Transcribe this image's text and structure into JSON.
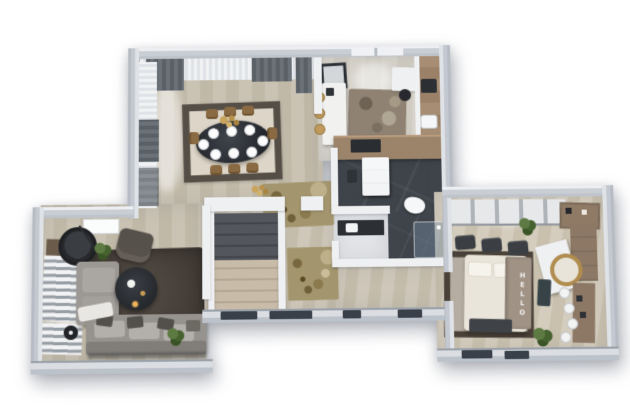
{
  "scene": {
    "title": "3D apartment floor plan render",
    "view": "top-down isometric",
    "background": "#ffffff"
  },
  "palette": {
    "wall": "#c9ced5",
    "wall-top": "#f4f5f7",
    "wall-inner": "#dadde2",
    "wood-light": "#cac3b4",
    "wood-hall": "#cfc8ba",
    "marble-dark": "#3f444b",
    "rug-cream": "#ddd5c7",
    "rug-border": "#554e46",
    "rug-gold": "#a3956d",
    "rug-charcoal": "#46403a",
    "rug-taupe": "#b5ada1",
    "sofa-gray": "#96928d",
    "cabinet-wood": "#a68d73",
    "accent-wood": "#8d7866",
    "table-dark": "#33373d",
    "chair-tan": "#8a6a42",
    "gold": "#b08c4e",
    "plant-green": "#4c6834",
    "shower-glass": "#7a90a8"
  },
  "rooms": [
    {
      "id": "dining-room",
      "features": [
        "oval-dining-table",
        "eight-place-settings",
        "tan-chairs",
        "gold-chandelier",
        "cream-rug",
        "gray-curtains"
      ]
    },
    {
      "id": "kitchen",
      "features": [
        "white-island",
        "bar-stools",
        "wood-cabinets",
        "sink",
        "window",
        "shag-rug",
        "desk-with-chair"
      ]
    },
    {
      "id": "bathroom",
      "features": [
        "dark-marble-floor",
        "white-vanity",
        "toilet",
        "glass-shower"
      ]
    },
    {
      "id": "wc",
      "features": [
        "dark-counter",
        "sink"
      ]
    },
    {
      "id": "hallway",
      "features": [
        "staircase",
        "gold-area-rugs",
        "gold-chandelier"
      ]
    },
    {
      "id": "living-room",
      "features": [
        "l-shaped-gray-sofa",
        "charcoal-rug",
        "round-coffee-table",
        "hanging-egg-chair",
        "armchair",
        "plants",
        "striped-bench"
      ]
    },
    {
      "id": "bedroom",
      "features": [
        "double-bed",
        "lettered-throw-blanket",
        "round-gold-mirror",
        "sliding-wardrobe",
        "wood-shelving",
        "white-stools",
        "dark-poufs",
        "plants"
      ]
    }
  ],
  "bedroom": {
    "blanket_text": "HELLO"
  }
}
